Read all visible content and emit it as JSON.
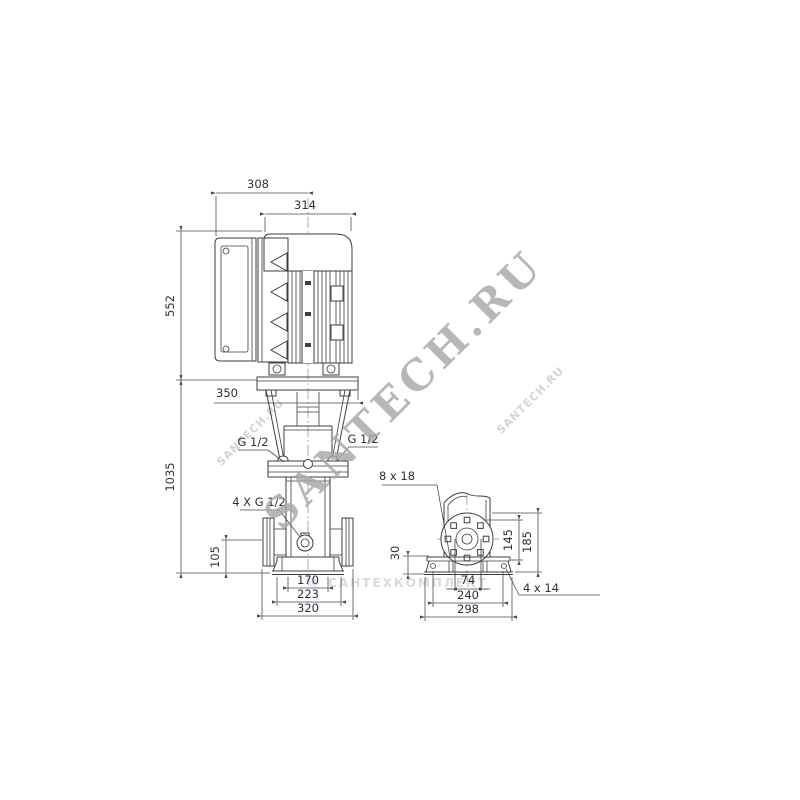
{
  "colors": {
    "drawing_line": "#3e3e3e",
    "dimension_line": "#4a4a55",
    "dimension_text": "#2e2e3c",
    "watermark_main": "#a8a8a8",
    "watermark_light": "#d4d4d4",
    "background": "#ffffff"
  },
  "front_view": {
    "dim_width_top": "308",
    "dim_motor_width": "314",
    "dim_motor_height": "552",
    "dim_pump_height": "1035",
    "dim_stool_width": "350",
    "port_left": "G 1/2",
    "port_right": "G 1/2",
    "ports_label": "4 X G 1/2",
    "dim_flange_height": "105",
    "dim_base_inner": "170",
    "dim_base_mid": "223",
    "dim_base_outer": "320"
  },
  "end_view": {
    "slot_label": "8 x 18",
    "dim_base_height": "30",
    "dim_bolt_spacing": "74",
    "dim_port_height": "145",
    "dim_top_height": "185",
    "dim_hole_spacing": "240",
    "dim_base_width": "298",
    "hole_label": "4 x 14"
  },
  "watermarks": {
    "main": "SANTECH.RU",
    "small_left": "SANTECH.RU",
    "small_right": "SANTECH.RU",
    "copyright": "© САНТЕХКОМПЛЕКТ"
  }
}
